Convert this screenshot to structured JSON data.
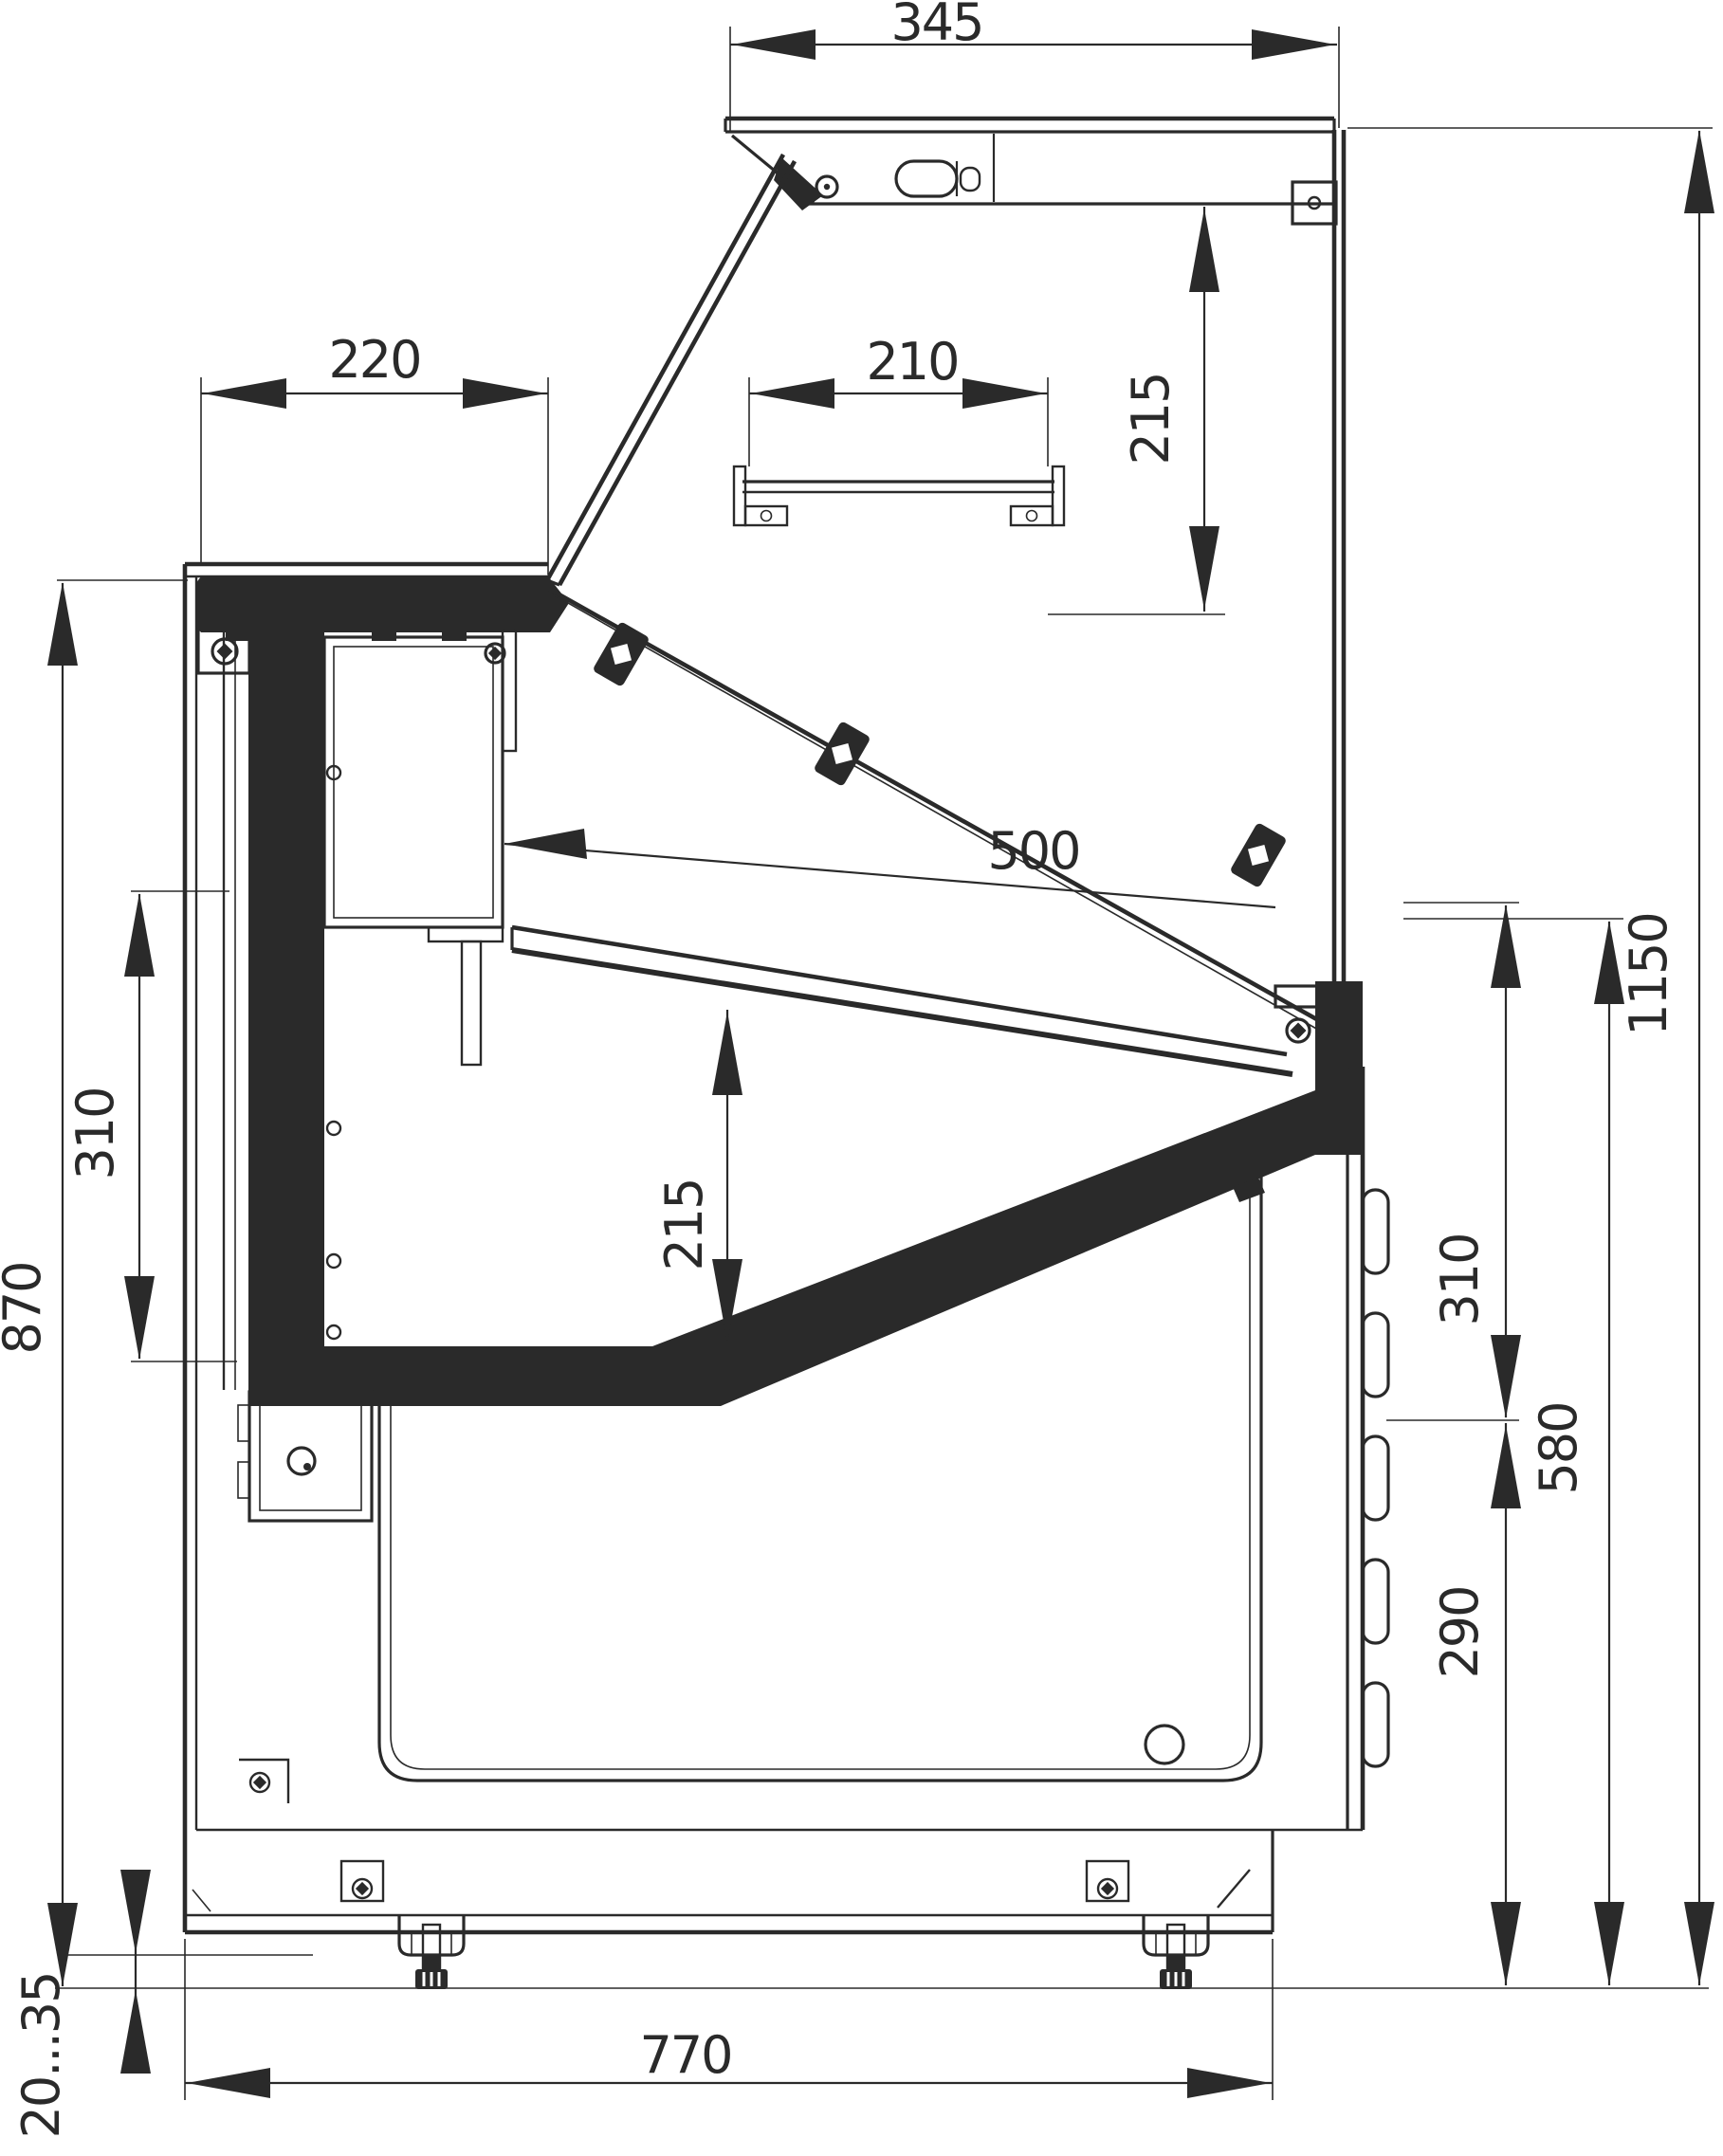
{
  "drawing": {
    "type": "technical-section-drawing",
    "subject": "serve-over refrigerated display counter, side cross-section",
    "units": "mm",
    "line_color": "#2a2a2a",
    "background_color": "#ffffff",
    "dimensions": {
      "canopy_depth": "345",
      "canopy_to_shelf": "215",
      "worktop_depth": "220",
      "shelf_depth": "210",
      "display_opening_length": "500",
      "display_inner_height": "215",
      "left_panel_height": "310",
      "worktop_height": "870",
      "overall_height": "1150",
      "right_upper_zone": "310",
      "right_condenser_zone": "580",
      "right_grille_zone": "290",
      "base_depth": "770",
      "foot_adjustment_range": "20...35"
    }
  }
}
